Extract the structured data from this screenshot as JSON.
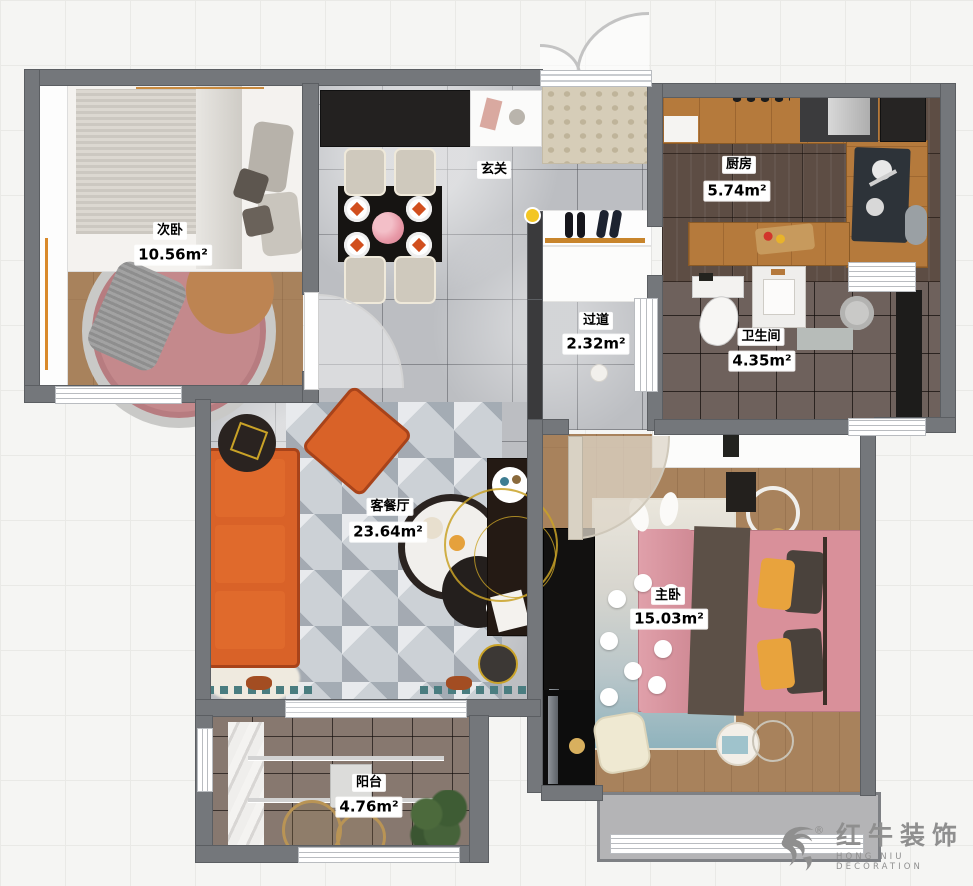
{
  "plan": {
    "rooms": [
      {
        "id": "ciwo",
        "name": "次卧",
        "area": "10.56m²"
      },
      {
        "id": "xuanguan",
        "name": "玄关",
        "area": ""
      },
      {
        "id": "chufang",
        "name": "厨房",
        "area": "5.74m²"
      },
      {
        "id": "guodao",
        "name": "过道",
        "area": "2.32m²"
      },
      {
        "id": "weishengjian",
        "name": "卫生间",
        "area": "4.35m²"
      },
      {
        "id": "kecanting",
        "name": "客餐厅",
        "area": "23.64m²"
      },
      {
        "id": "zhuwo",
        "name": "主卧",
        "area": "15.03m²"
      },
      {
        "id": "yangtai",
        "name": "阳台",
        "area": "4.76m²"
      }
    ]
  },
  "logo": {
    "brand": "红牛装饰",
    "sub": "HONG NIU DECORATION",
    "registered": "®"
  },
  "palette": {
    "wall": "#74777b",
    "marble_floor": "#bcbec2",
    "wood_floor": "#a8825c",
    "kitchen_floor": "#5d4d44",
    "bath_floor": "#6e615c",
    "balcony_floor": "#87786f",
    "sofa_orange": "#d96228",
    "bed_pink": "#d9909a",
    "pillow_yellow": "#e8a33d",
    "rug_pink": "#c4898c",
    "cabinet_wood": "#b57a3c",
    "cabinet_black": "#232120",
    "marker_yellow": "#f3c623",
    "logo_grey": "#8f8f8f"
  }
}
